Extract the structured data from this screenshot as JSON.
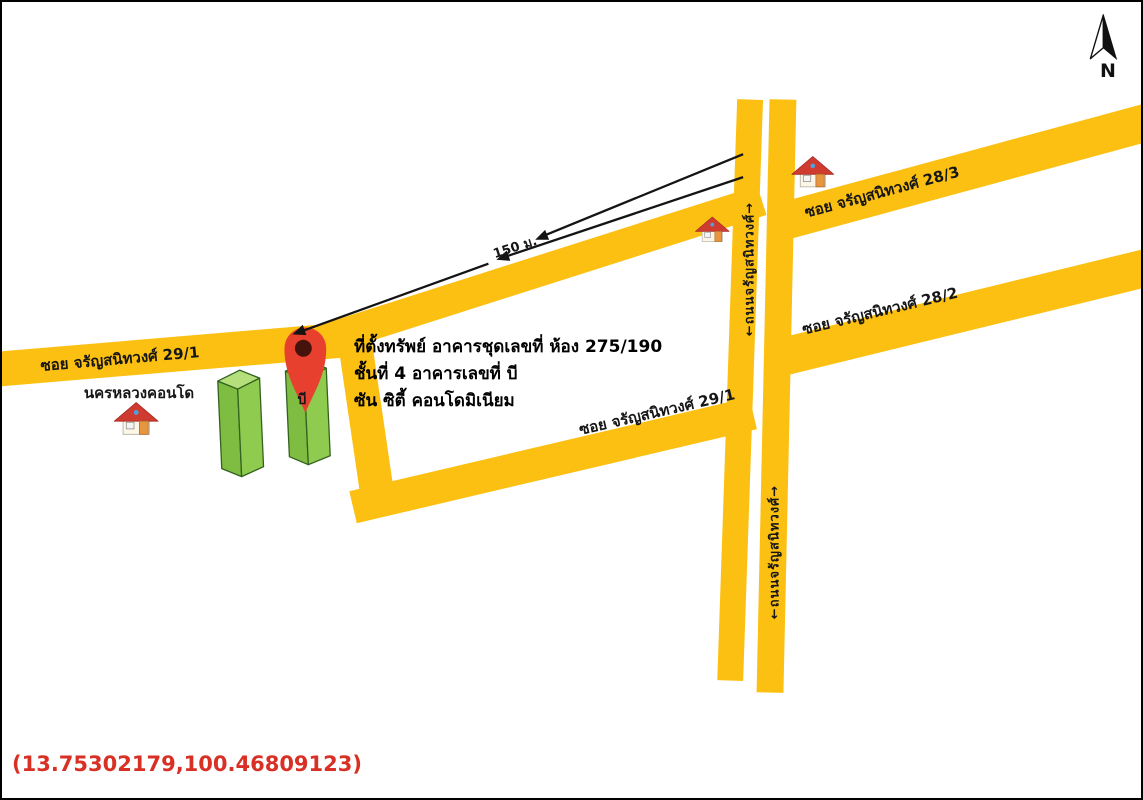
{
  "map": {
    "compass_label": "N",
    "coordinates": "(13.75302179,100.46809123)",
    "property_info": {
      "line1": "ที่ตั้งทรัพย์ อาคารชุดเลขที่ ห้อง 275/190",
      "line2": "ชั้นที่ 4 อาคารเลขที่ บี",
      "line3": "ซัน ซิตี้ คอนโดมิเนียม"
    },
    "road_labels": {
      "soi_29_1_left": "ซอย จรัญสนิทวงศ์ 29/1",
      "soi_29_1_right": "ซอย จรัญสนิทวงศ์ 29/1",
      "soi_28_3": "ซอย จรัญสนิทวงศ์ 28/3",
      "soi_28_2": "ซอย จรัญสนิทวงศ์ 28/2",
      "main_road_upper": "←ถนนจรัญสนิทวงศ์→",
      "main_road_lower": "←ถนนจรัญสนิทวงศ์→"
    },
    "poi_labels": {
      "condo_nakornluang": "นครหลวงคอนโด",
      "building_b": "บี"
    },
    "distance_label": "150 ม.",
    "icons": {
      "north_arrow": "north-arrow-icon",
      "location_pin": "location-pin-icon",
      "houses": [
        "house-icon",
        "house-icon",
        "house-icon"
      ]
    },
    "colors": {
      "road": "#FBC012",
      "pin_red": "#E8402E",
      "pin_center": "#45130C",
      "building_front": "#8FCB4E",
      "building_side": "#7FBC42",
      "building_top": "#B4DF7B",
      "building_outline": "#33611F",
      "house_roof": "#CF3B2F",
      "house_body": "#FCF6E6",
      "house_door": "#E8953F",
      "line_black": "#141414",
      "coordinates_red": "#D93025"
    }
  }
}
